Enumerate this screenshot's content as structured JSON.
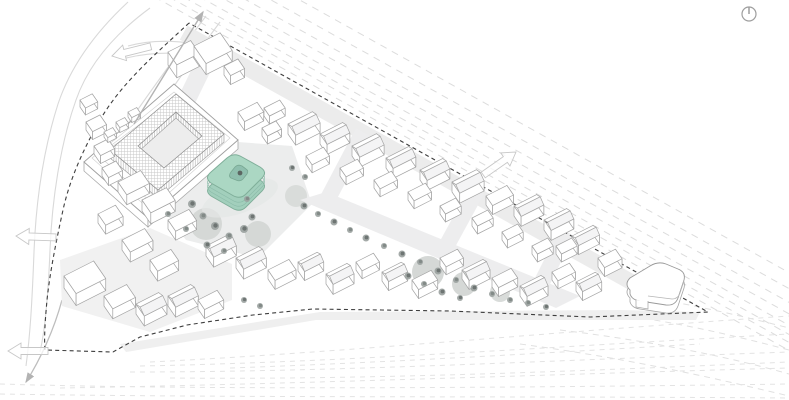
{
  "app": {
    "kind": "architectural-axonometric-site-plan-diagram",
    "visible_text": []
  },
  "colors": {
    "background": "#ffffff",
    "boundary_line": "#3e3e3e",
    "rail_line": "#dcdcdc",
    "rail_line_light": "#e3e3e3",
    "road_line": "#d9d9d9",
    "ground": "#ececec",
    "ground_patch": "#d5d8d6",
    "building_fill": "#ffffff",
    "building_stroke": "#a4a4a4",
    "roof_shade": "#f4f4f5",
    "hatch_line": "#bdbdbd",
    "tree": "#9aa19e",
    "tree_dark": "#6e7573",
    "arrow": "#b3b3b3",
    "arrow_outline": "#c7c7c7",
    "accent_roof": "#abd7c3",
    "accent_wall": "#a2cfbc",
    "accent_court": "#8fbfae",
    "accent_stroke": "#7fae99"
  },
  "icons": {
    "north_indicator": "circle-with-needle"
  },
  "scene": {
    "site_boundary": "dashed-outline",
    "highlighted_building": "rounded-square-block-with-courtyard",
    "courtyard_block": "large-hatched-perimeter-block",
    "context_buildings": "white-axonometric-massing",
    "railway_tracks": "dashed-parallel-lines",
    "direction_arrows": "road-flow-arrows"
  }
}
